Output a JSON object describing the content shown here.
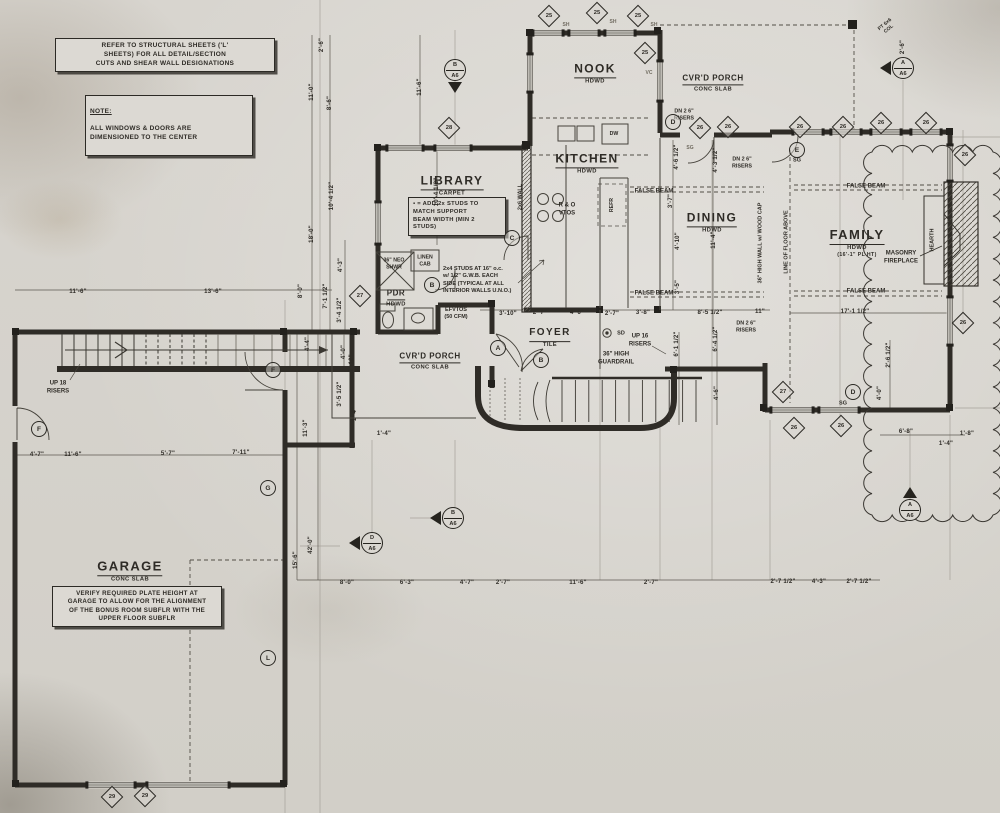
{
  "sheet": {
    "paper": "#d8d5cf",
    "ink": "#2e2b26"
  },
  "notes": {
    "structural": "REFER TO STRUCTURAL SHEETS ('L'\nSHEETS) FOR ALL DETAIL/SECTION\nCUTS AND SHEAR WALL DESIGNATIONS",
    "note_title": "NOTE:",
    "note_body": "ALL WINDOWS & DOORS ARE\nDIMENSIONED TO THE CENTER",
    "stud_note": "▪ = ADD 2x STUDS TO\nMATCH SUPPORT\nBEAM WIDTH (MIN 2\nSTUDS)",
    "interior_note": "2x4 STUDS AT 16\" o.c.\nw/ 1/2\" G.W.B. EACH\nSIDE (TYPICAL AT ALL\nINTERIOR WALLS U.N.O.)",
    "garage_note": "VERIFY REQUIRED PLATE HEIGHT AT\nGARAGE TO ALLOW FOR THE ALIGNMENT\nOF THE BONUS ROOM SUBFLR WITH THE\nUPPER FLOOR SUBFLR"
  },
  "rooms": [
    {
      "name": "NOOK",
      "sub": "HDWD",
      "x": 595,
      "y": 72,
      "sz": 12
    },
    {
      "name": "KITCHEN",
      "sub": "HDWD",
      "x": 587,
      "y": 162,
      "sz": 12
    },
    {
      "name": "LIBRARY",
      "sub": "CARPET",
      "x": 452,
      "y": 184,
      "sz": 12
    },
    {
      "name": "DINING",
      "sub": "HDWD",
      "x": 712,
      "y": 221,
      "sz": 12
    },
    {
      "name": "FAMILY",
      "sub": "HDWD",
      "sub2": "(16'-1\" PL HT)",
      "x": 857,
      "y": 242,
      "sz": 13
    },
    {
      "name": "FOYER",
      "sub": "TILE",
      "x": 550,
      "y": 335,
      "sz": 10
    },
    {
      "name": "GARAGE",
      "sub": "CONC SLAB",
      "x": 130,
      "y": 570,
      "sz": 13
    },
    {
      "name": "CVR'D PORCH",
      "sub": "CONC SLAB",
      "x": 713,
      "y": 80,
      "sz": 8
    },
    {
      "name": "CVR'D PORCH",
      "sub": "CONC SLAB",
      "x": 430,
      "y": 358,
      "sz": 8
    },
    {
      "name": "PDR",
      "sub": "HDWD",
      "x": 396,
      "y": 295,
      "sz": 8
    }
  ],
  "annotations": [
    {
      "t": "2x6 WALL",
      "x": 521,
      "y": 197,
      "r": -90,
      "s": 5.5
    },
    {
      "t": "LINEN\nCAB",
      "x": 425,
      "y": 261,
      "s": 5.2
    },
    {
      "t": "36\" NEO\nSHWR",
      "x": 394,
      "y": 264,
      "s": 5.2
    },
    {
      "t": "R & O\nVTOS",
      "x": 567,
      "y": 210,
      "s": 6
    },
    {
      "t": "REFR",
      "x": 612,
      "y": 205,
      "r": -90,
      "s": 5.2
    },
    {
      "t": "DW",
      "x": 614,
      "y": 134,
      "s": 5.2
    },
    {
      "t": "EFVTOS\n(50 CFM)",
      "x": 456,
      "y": 314,
      "s": 5.5
    },
    {
      "t": "FALSE BEAM",
      "x": 654,
      "y": 192,
      "s": 6
    },
    {
      "t": "FALSE BEAM",
      "x": 654,
      "y": 294,
      "s": 6
    },
    {
      "t": "FALSE BEAM",
      "x": 866,
      "y": 187,
      "s": 6
    },
    {
      "t": "FALSE BEAM",
      "x": 866,
      "y": 292,
      "s": 6
    },
    {
      "t": "MASONRY\nFIREPLACE",
      "x": 901,
      "y": 258,
      "s": 6
    },
    {
      "t": "HEARTH",
      "x": 933,
      "y": 240,
      "r": -90,
      "s": 5.5
    },
    {
      "t": "LINE OF FLOOR ABOVE",
      "x": 787,
      "y": 242,
      "r": -90,
      "s": 5.5
    },
    {
      "t": "36\" HIGH WALL w/ WOOD CAP",
      "x": 761,
      "y": 243,
      "r": -90,
      "s": 5.5
    },
    {
      "t": "36\" HIGH\nGUARDRAIL",
      "x": 616,
      "y": 359,
      "s": 6
    },
    {
      "t": "UP 16\nRISERS",
      "x": 640,
      "y": 341,
      "s": 6
    },
    {
      "t": "UP 18\nRISERS",
      "x": 58,
      "y": 388,
      "s": 6
    },
    {
      "t": "DN 2 6\"\nRISERS",
      "x": 684,
      "y": 115,
      "s": 5.4
    },
    {
      "t": "DN 2 6\"\nRISERS",
      "x": 742,
      "y": 163,
      "s": 5.4
    },
    {
      "t": "DN 2 6\"\nRISERS",
      "x": 746,
      "y": 327,
      "s": 5.4
    },
    {
      "t": "SD",
      "x": 621,
      "y": 334,
      "s": 5.5
    },
    {
      "t": "SG",
      "x": 673,
      "y": 136,
      "s": 5.5
    },
    {
      "t": "SG",
      "x": 797,
      "y": 161,
      "s": 5.5
    },
    {
      "t": "SG",
      "x": 843,
      "y": 404,
      "s": 5.5
    },
    {
      "t": "SG",
      "x": 690,
      "y": 148,
      "s": 5,
      "hand": true
    },
    {
      "t": "PT 6x6\nCOL",
      "x": 887,
      "y": 27,
      "r": -40,
      "s": 5
    },
    {
      "t": "SH",
      "x": 566,
      "y": 25,
      "s": 5,
      "hand": true
    },
    {
      "t": "SH",
      "x": 613,
      "y": 22,
      "s": 5,
      "hand": true
    },
    {
      "t": "SH",
      "x": 654,
      "y": 25,
      "s": 5,
      "hand": true
    },
    {
      "t": "VC",
      "x": 649,
      "y": 73,
      "s": 5,
      "hand": true
    }
  ],
  "dims": [
    {
      "t": "2'-6\"",
      "x": 322,
      "y": 45,
      "r": -90
    },
    {
      "t": "11'-0\"",
      "x": 312,
      "y": 92,
      "r": -90
    },
    {
      "t": "8'-6\"",
      "x": 330,
      "y": 103,
      "r": -90
    },
    {
      "t": "11'-6\"",
      "x": 420,
      "y": 87,
      "r": -90
    },
    {
      "t": "10'-4 1/2\"",
      "x": 332,
      "y": 196,
      "r": -90
    },
    {
      "t": "10'-4 1/2\"",
      "x": 437,
      "y": 192,
      "r": -90
    },
    {
      "t": "18'-0\"",
      "x": 312,
      "y": 234,
      "r": -90
    },
    {
      "t": "4'-3\"",
      "x": 341,
      "y": 265,
      "r": -90
    },
    {
      "t": "8'-0\"",
      "x": 301,
      "y": 291,
      "r": -90
    },
    {
      "t": "7'-1 1/2\"",
      "x": 326,
      "y": 296,
      "r": -90
    },
    {
      "t": "3'-4 1/2\"",
      "x": 340,
      "y": 310,
      "r": -90
    },
    {
      "t": "4'-4\"",
      "x": 308,
      "y": 344,
      "r": -90
    },
    {
      "t": "4'-0\"",
      "x": 344,
      "y": 352,
      "r": -90
    },
    {
      "t": "6'-10\"",
      "x": 352,
      "y": 363,
      "r": -90
    },
    {
      "t": "3'-5 1/2\"",
      "x": 340,
      "y": 394,
      "r": -90
    },
    {
      "t": "11'-3\"",
      "x": 306,
      "y": 428,
      "r": -90
    },
    {
      "t": "1'-4\"",
      "x": 355,
      "y": 414,
      "r": -90
    },
    {
      "t": "15'-6\"",
      "x": 296,
      "y": 560,
      "r": -90
    },
    {
      "t": "42'-0\"",
      "x": 311,
      "y": 545,
      "r": -90
    },
    {
      "t": "11'-6\"",
      "x": 78,
      "y": 292
    },
    {
      "t": "13'-6\"",
      "x": 213,
      "y": 292
    },
    {
      "t": "4'-7\"",
      "x": 37,
      "y": 455
    },
    {
      "t": "11'-6\"",
      "x": 73,
      "y": 455
    },
    {
      "t": "5'-7\"",
      "x": 168,
      "y": 454
    },
    {
      "t": "7'-11\"",
      "x": 241,
      "y": 453
    },
    {
      "t": "8'-0\"",
      "x": 347,
      "y": 583
    },
    {
      "t": "6'-3\"",
      "x": 407,
      "y": 583
    },
    {
      "t": "4'-7\"",
      "x": 467,
      "y": 583
    },
    {
      "t": "2'-7\"",
      "x": 503,
      "y": 583
    },
    {
      "t": "11'-6\"",
      "x": 578,
      "y": 583
    },
    {
      "t": "2'-7\"",
      "x": 651,
      "y": 583
    },
    {
      "t": "2'-7 1/2\"",
      "x": 783,
      "y": 582
    },
    {
      "t": "4'-3\"",
      "x": 819,
      "y": 582
    },
    {
      "t": "2'-7 1/2\"",
      "x": 859,
      "y": 582
    },
    {
      "t": "3'-10\"",
      "x": 508,
      "y": 314
    },
    {
      "t": "2'-7\"",
      "x": 540,
      "y": 313
    },
    {
      "t": "4'-6\"",
      "x": 577,
      "y": 313
    },
    {
      "t": "2'-7\"",
      "x": 612,
      "y": 314
    },
    {
      "t": "3'-8\"",
      "x": 643,
      "y": 313
    },
    {
      "t": "8'-5 1/2\"",
      "x": 710,
      "y": 313
    },
    {
      "t": "11\"",
      "x": 760,
      "y": 312
    },
    {
      "t": "4'-6 1/2\"",
      "x": 677,
      "y": 157,
      "r": -90
    },
    {
      "t": "4'-3 1/2\"",
      "x": 716,
      "y": 160,
      "r": -90
    },
    {
      "t": "3'-7\"",
      "x": 671,
      "y": 201,
      "r": -90
    },
    {
      "t": "4'-10\"",
      "x": 678,
      "y": 241,
      "r": -90
    },
    {
      "t": "3'-5\"",
      "x": 678,
      "y": 287,
      "r": -90
    },
    {
      "t": "11'-4\"",
      "x": 714,
      "y": 240,
      "r": -90
    },
    {
      "t": "6'-1 1/2\"",
      "x": 677,
      "y": 344,
      "r": -90
    },
    {
      "t": "6'-4 1/2\"",
      "x": 716,
      "y": 339,
      "r": -90
    },
    {
      "t": "4'-6\"",
      "x": 717,
      "y": 393,
      "r": -90
    },
    {
      "t": "17'-1 1/2\"",
      "x": 855,
      "y": 312
    },
    {
      "t": "2'-6 1/2\"",
      "x": 889,
      "y": 355,
      "r": -90
    },
    {
      "t": "4'-0\"",
      "x": 880,
      "y": 393,
      "r": -90
    },
    {
      "t": "6'-8\"",
      "x": 906,
      "y": 432
    },
    {
      "t": "1'-4\"",
      "x": 946,
      "y": 444
    },
    {
      "t": "1'-8\"",
      "x": 967,
      "y": 434
    },
    {
      "t": "1'-4\"",
      "x": 384,
      "y": 434
    },
    {
      "t": "2'-6\"",
      "x": 903,
      "y": 47,
      "r": -90
    }
  ],
  "markers": {
    "diamonds": [
      {
        "n": "25",
        "x": 549,
        "y": 16
      },
      {
        "n": "25",
        "x": 597,
        "y": 13
      },
      {
        "n": "25",
        "x": 638,
        "y": 16
      },
      {
        "n": "25",
        "x": 645,
        "y": 53
      },
      {
        "n": "28",
        "x": 449,
        "y": 128
      },
      {
        "n": "26",
        "x": 700,
        "y": 128
      },
      {
        "n": "26",
        "x": 728,
        "y": 127
      },
      {
        "n": "26",
        "x": 800,
        "y": 127
      },
      {
        "n": "26",
        "x": 843,
        "y": 127
      },
      {
        "n": "26",
        "x": 881,
        "y": 123
      },
      {
        "n": "26",
        "x": 926,
        "y": 123
      },
      {
        "n": "26",
        "x": 965,
        "y": 155
      },
      {
        "n": "26",
        "x": 963,
        "y": 323
      },
      {
        "n": "27",
        "x": 360,
        "y": 296
      },
      {
        "n": "27",
        "x": 783,
        "y": 392
      },
      {
        "n": "26",
        "x": 794,
        "y": 428
      },
      {
        "n": "26",
        "x": 841,
        "y": 426
      },
      {
        "n": "29",
        "x": 112,
        "y": 797
      },
      {
        "n": "29",
        "x": 145,
        "y": 796
      }
    ],
    "circles": [
      {
        "l": "A",
        "x": 498,
        "y": 348
      },
      {
        "l": "B",
        "x": 541,
        "y": 360
      },
      {
        "l": "B",
        "x": 432,
        "y": 285
      },
      {
        "l": "C",
        "x": 512,
        "y": 238
      },
      {
        "l": "D",
        "x": 673,
        "y": 122
      },
      {
        "l": "D",
        "x": 853,
        "y": 392
      },
      {
        "l": "E",
        "x": 797,
        "y": 150
      },
      {
        "l": "F",
        "x": 39,
        "y": 429
      },
      {
        "l": "F",
        "x": 273,
        "y": 370
      },
      {
        "l": "G",
        "x": 268,
        "y": 488
      },
      {
        "l": "L",
        "x": 268,
        "y": 658
      }
    ],
    "sections": [
      {
        "t": "B",
        "b": "A6",
        "x": 455,
        "y": 70,
        "tri": "down"
      },
      {
        "t": "A",
        "b": "A6",
        "x": 903,
        "y": 68,
        "tri": "left"
      },
      {
        "t": "D",
        "b": "A6",
        "x": 372,
        "y": 543,
        "tri": "left"
      },
      {
        "t": "B",
        "b": "A6",
        "x": 453,
        "y": 518,
        "tri": "left"
      },
      {
        "t": "A",
        "b": "A6",
        "x": 910,
        "y": 510,
        "tri": "up"
      }
    ]
  }
}
